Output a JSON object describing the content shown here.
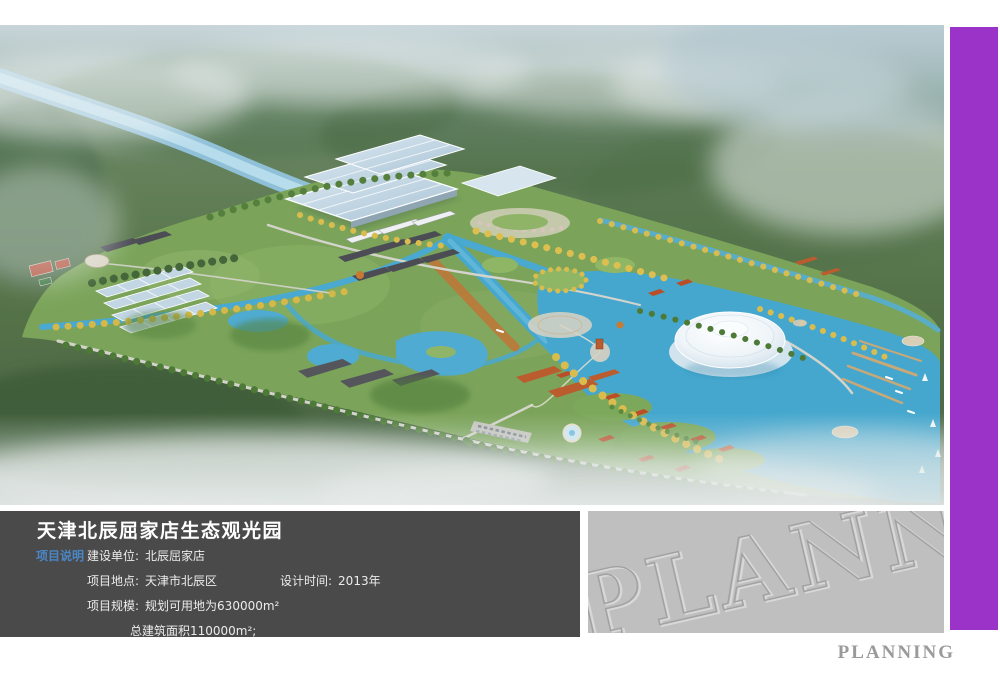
{
  "page": {
    "background": "#ffffff"
  },
  "accent_bar": {
    "color": "#9b33c9"
  },
  "info_panel": {
    "background": "#4a4a4a",
    "title": "天津北辰屈家店生态观光园",
    "section_label": "项目说明",
    "section_label_color": "#4a86c6",
    "fields": {
      "owner_label": "建设单位:",
      "owner_value": "北辰屈家店",
      "location_label": "项目地点:",
      "location_value": "天津市北辰区",
      "design_time_label": "设计时间:",
      "design_time_value": "2013年",
      "scale_label": "项目规模:",
      "scale_value": "规划可用地为630000m²",
      "floor_area_value": "总建筑面积110000m²;"
    }
  },
  "watermark_panel": {
    "background": "#bfbfbf",
    "text": "PLANNING"
  },
  "footer": {
    "brand_label": "PLANNING",
    "color": "#9a9a9a"
  },
  "rendering": {
    "palette": {
      "park_green": "#7ba45a",
      "lake_water": "#45a7ce",
      "river_water": "#b7dcec",
      "autumn_yellow": "#d9bc4e",
      "forest_green": "#44663a",
      "dome_white": "#f2f7fa",
      "roof_orange": "#bb5c2f",
      "roof_dark": "#4c4c55",
      "fog": "#eff3f4"
    }
  }
}
